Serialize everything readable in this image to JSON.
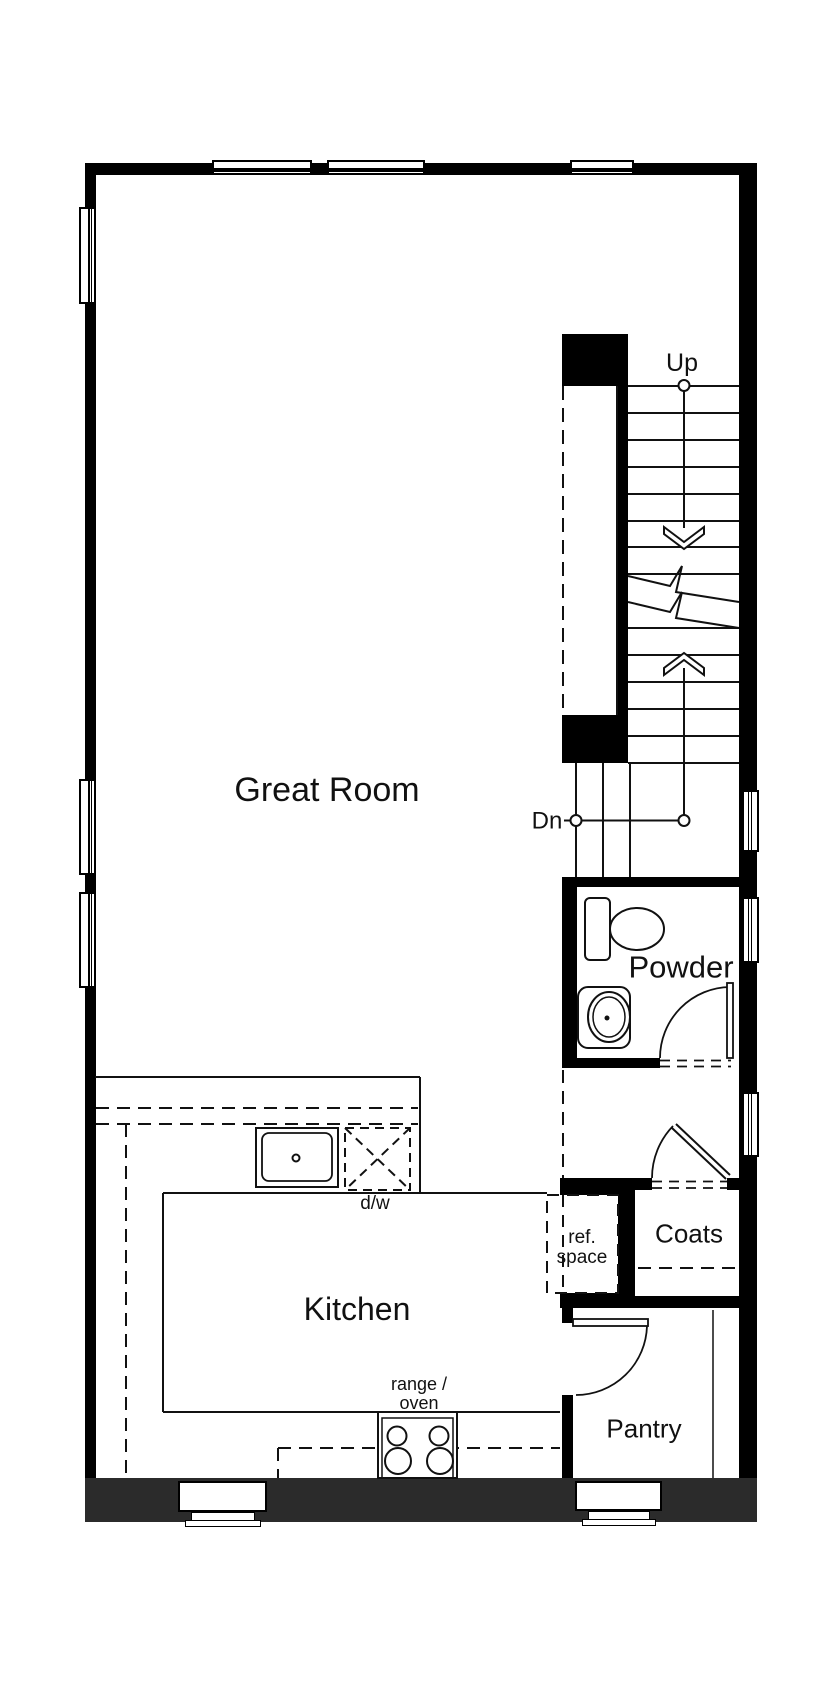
{
  "rooms": {
    "great_room": {
      "label": "Great Room"
    },
    "kitchen": {
      "label": "Kitchen"
    },
    "powder": {
      "label": "Powder"
    },
    "coats": {
      "label": "Coats"
    },
    "pantry": {
      "label": "Pantry"
    }
  },
  "stairs": {
    "up_label": "Up",
    "down_label": "Dn"
  },
  "fixtures": {
    "dishwasher_label": "d/w",
    "ref_space_line1": "ref.",
    "ref_space_line2": "space",
    "range_line1": "range /",
    "range_line2": "oven"
  },
  "colors": {
    "wall": "#000000",
    "foundation_wall": "#2b2b2b",
    "line": "#111111",
    "background": "#ffffff"
  }
}
